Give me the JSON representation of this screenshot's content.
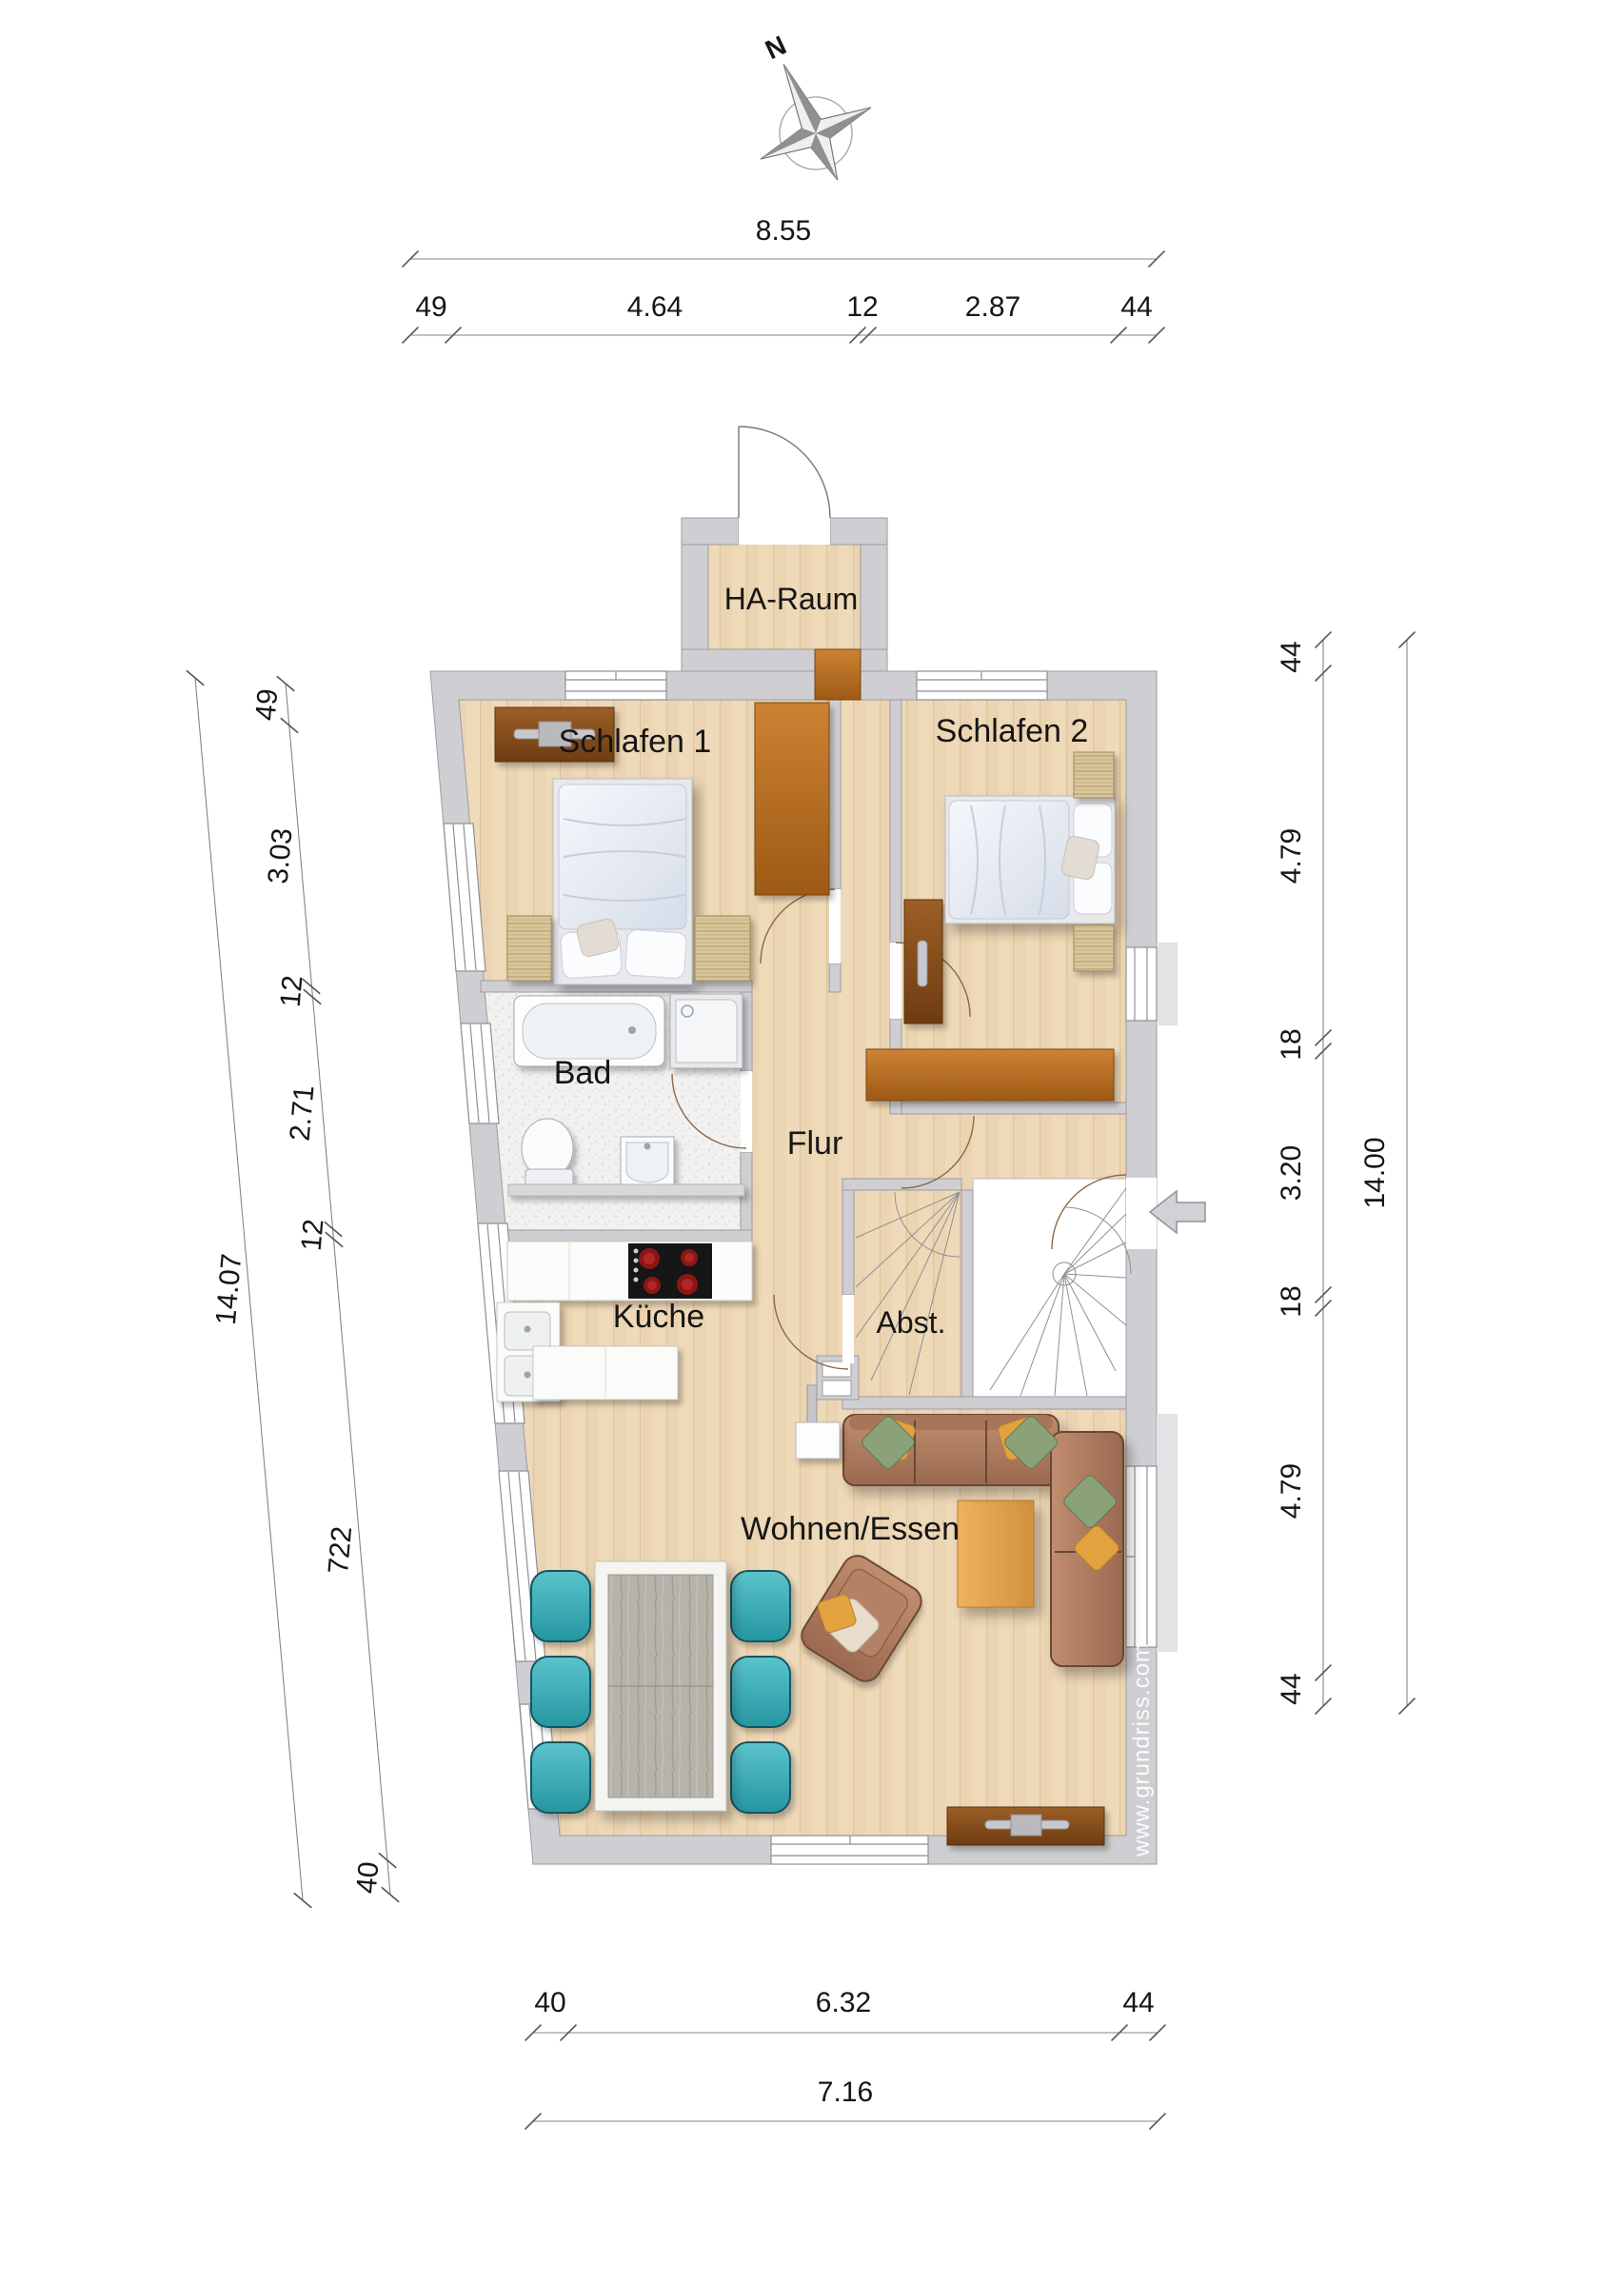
{
  "compass": {
    "north": "N"
  },
  "watermark": "www.grundriss.com",
  "rooms": {
    "ha_raum": "HA-Raum",
    "schlafen1": "Schlafen 1",
    "schlafen2": "Schlafen 2",
    "bad": "Bad",
    "flur": "Flur",
    "kueche": "Küche",
    "abst": "Abst.",
    "wohnen": "Wohnen/Essen"
  },
  "dimensions": {
    "top_total": "8.55",
    "top_chain": [
      "49",
      "4.64",
      "12",
      "2.87",
      "44"
    ],
    "left_total": "14.07",
    "left_chain": [
      "49",
      "3.03",
      "12",
      "2.71",
      "12",
      "722",
      "40"
    ],
    "right_total": "14.00",
    "right_chain": [
      "44",
      "4.79",
      "18",
      "3.20",
      "18",
      "4.79",
      "44"
    ],
    "bottom_chain": [
      "40",
      "6.32",
      "44"
    ],
    "bottom_total": "7.16"
  },
  "colors": {
    "wall": "#cfcfd3",
    "floor_wood": "#eed9b8",
    "floor_tile": "#f0f0ee",
    "dark_wood": "#8a4d1d",
    "accent_teal": "#3ab0bc"
  }
}
